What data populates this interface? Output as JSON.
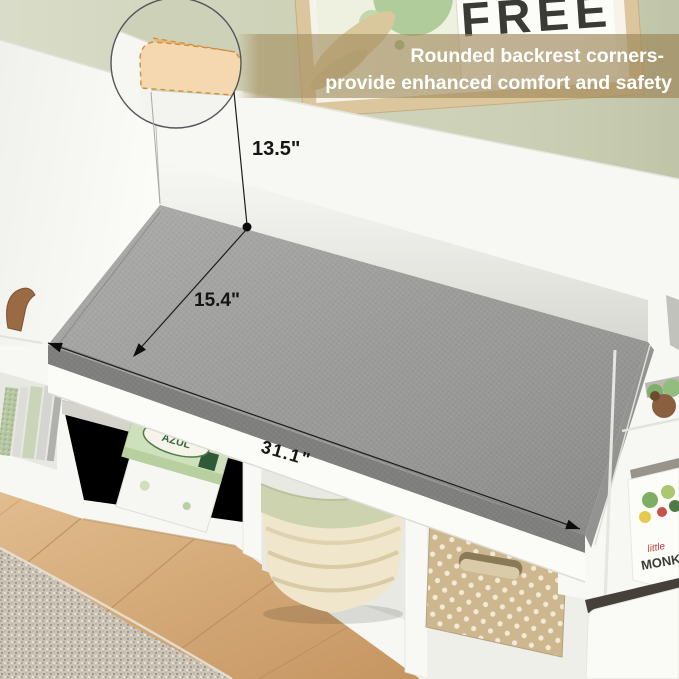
{
  "overlay": {
    "headline_line1": "Rounded backrest corners-",
    "headline_line2": "provide enhanced comfort and safety",
    "dim_backrest_height": "13.5\"",
    "dim_seat_depth": "15.4\"",
    "dim_seat_width": "31.1\""
  },
  "wall_art": {
    "poster_word": "FREE"
  },
  "items": {
    "game_box_label": "AZUL",
    "book_title_script": "little",
    "book_title_bold": "MONKE"
  },
  "colors": {
    "wall": "#cdd1b6",
    "overlay_band": "#a58f60",
    "cushion": "#969694",
    "cushion_front": "#7f7f7d",
    "corner_highlight": "#f5d8b0",
    "corner_highlight_dash": "#cf8f3f",
    "furniture_white": "#f7f7f3",
    "floor": "#d9ae7c",
    "rug": "#ccc4b7",
    "headline_text": "#ffffff",
    "annotation": "#1c1c1c"
  }
}
